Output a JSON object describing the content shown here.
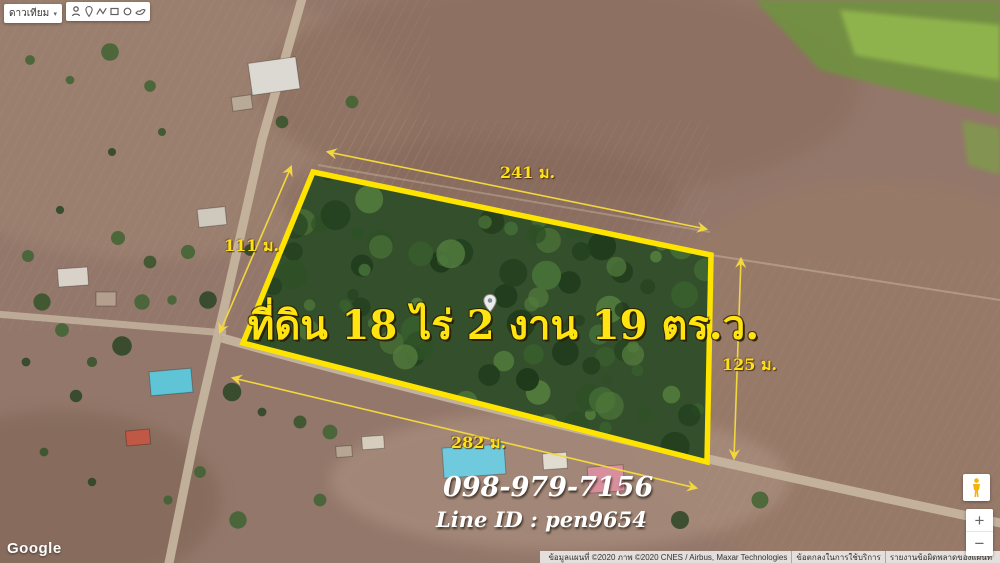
{
  "map_type_control": {
    "label": "ดาวเทียม",
    "caret": "▾"
  },
  "toolbar": {
    "icons": [
      "pan-icon",
      "marker-icon",
      "polyline-icon",
      "rectangle-icon",
      "circle-icon",
      "hand-icon"
    ]
  },
  "overlay": {
    "title": "ที่ดิน 18 ไร่ 2 งาน 19 ตร.ว.",
    "dimensions": {
      "top": "241 ม.",
      "left": "111 ม.",
      "right": "125 ม.",
      "bottom": "282 ม."
    },
    "contact": {
      "phone": "098-979-7156",
      "line_id": "Line ID : pen9654"
    },
    "colors": {
      "plot_outline": "#FFE400",
      "label_yellow": "#FFE11A",
      "contact_white": "#FFFFFF"
    }
  },
  "branding": {
    "logo_text": "Google"
  },
  "attribution": {
    "map_data": "ข้อมูลแผนที่ ©2020 ภาพ ©2020 CNES / Airbus, Maxar Technologies",
    "terms": "ข้อตกลงในการใช้บริการ",
    "report_error": "รายงานข้อผิดพลาดของแผนที่"
  },
  "zoom_control": {
    "zoom_in_label": "+",
    "zoom_out_label": "−"
  }
}
